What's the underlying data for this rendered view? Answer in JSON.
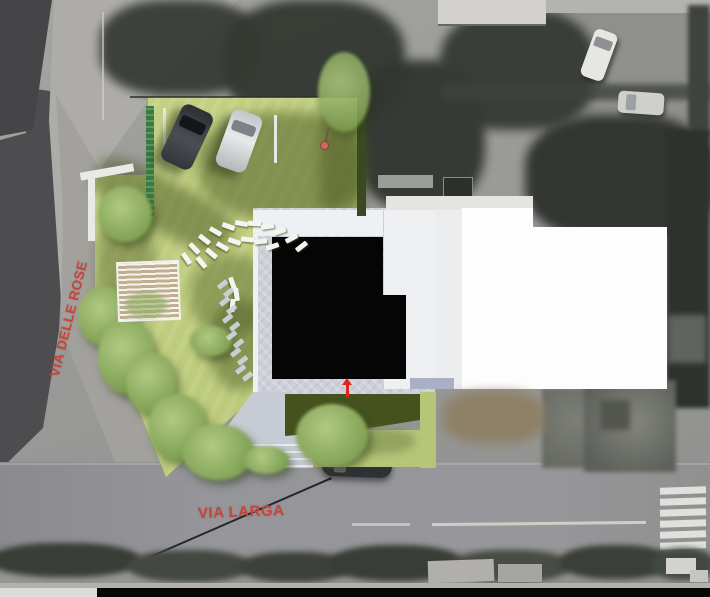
{
  "image": {
    "type": "architectural site plan rendering overlaid on grayscale aerial photo",
    "width_px": 710,
    "height_px": 597
  },
  "streets": {
    "left_vertical": {
      "label": "VIA DELLE ROSE"
    },
    "bottom_horizontal": {
      "label": "VIA LARGA"
    }
  },
  "colors": {
    "street_label_red": "#c6453b",
    "entrance_arrow_red": "#e0231c",
    "lawn_green": "#bdcb7c",
    "lawn_shadow_green": "#47551f",
    "black_building": "#050505",
    "white_building": "#fdfdfe",
    "pale_building": "#f0f1f3",
    "paving_gray": "#ccd0d9",
    "road_gray": "#96969a",
    "aerial_dark_trees": "#343932"
  },
  "site": {
    "parked_cars_on_plan": 2,
    "deck_chairs": [
      {
        "x": 180,
        "y": 256,
        "r": 55
      },
      {
        "x": 188,
        "y": 246,
        "r": 46
      },
      {
        "x": 198,
        "y": 237,
        "r": 38
      },
      {
        "x": 209,
        "y": 229,
        "r": 30
      },
      {
        "x": 222,
        "y": 224,
        "r": 20
      },
      {
        "x": 235,
        "y": 221,
        "r": 10
      },
      {
        "x": 248,
        "y": 221,
        "r": 2
      },
      {
        "x": 261,
        "y": 224,
        "r": -8
      },
      {
        "x": 273,
        "y": 229,
        "r": -18
      },
      {
        "x": 285,
        "y": 236,
        "r": -28
      },
      {
        "x": 295,
        "y": 244,
        "r": -38
      },
      {
        "x": 195,
        "y": 260,
        "r": 50
      },
      {
        "x": 205,
        "y": 251,
        "r": 40
      },
      {
        "x": 216,
        "y": 244,
        "r": 30
      },
      {
        "x": 228,
        "y": 239,
        "r": 18
      },
      {
        "x": 241,
        "y": 237,
        "r": 6
      },
      {
        "x": 254,
        "y": 239,
        "r": -6
      },
      {
        "x": 266,
        "y": 244,
        "r": -18
      },
      {
        "x": 226,
        "y": 281,
        "r": 70
      },
      {
        "x": 230,
        "y": 292,
        "r": 82
      },
      {
        "x": 226,
        "y": 303,
        "r": 95
      }
    ],
    "stepping_stones": [
      {
        "x": 217,
        "y": 282
      },
      {
        "x": 223,
        "y": 290
      },
      {
        "x": 219,
        "y": 299
      },
      {
        "x": 226,
        "y": 307
      },
      {
        "x": 222,
        "y": 316
      },
      {
        "x": 229,
        "y": 324
      },
      {
        "x": 226,
        "y": 333
      },
      {
        "x": 233,
        "y": 341
      },
      {
        "x": 230,
        "y": 350
      },
      {
        "x": 237,
        "y": 358
      },
      {
        "x": 235,
        "y": 367
      },
      {
        "x": 242,
        "y": 374
      }
    ],
    "path_steps": [
      {
        "x": 200,
        "y": 444
      },
      {
        "x": 202,
        "y": 451
      },
      {
        "x": 204,
        "y": 458
      },
      {
        "x": 206,
        "y": 465
      }
    ]
  },
  "road_markings": {
    "crosswalk_stripes": [
      {
        "x": 660,
        "y": 487,
        "w": 46,
        "h": 6.5,
        "r": -2
      },
      {
        "x": 660,
        "y": 498,
        "w": 46,
        "h": 6.5,
        "r": -2
      },
      {
        "x": 660,
        "y": 509,
        "w": 46,
        "h": 6.5,
        "r": -2
      },
      {
        "x": 660,
        "y": 520,
        "w": 46,
        "h": 6.5,
        "r": -2
      },
      {
        "x": 660,
        "y": 531,
        "w": 46,
        "h": 6.5,
        "r": -2
      },
      {
        "x": 660,
        "y": 542,
        "w": 46,
        "h": 6.5,
        "r": -2
      }
    ]
  }
}
